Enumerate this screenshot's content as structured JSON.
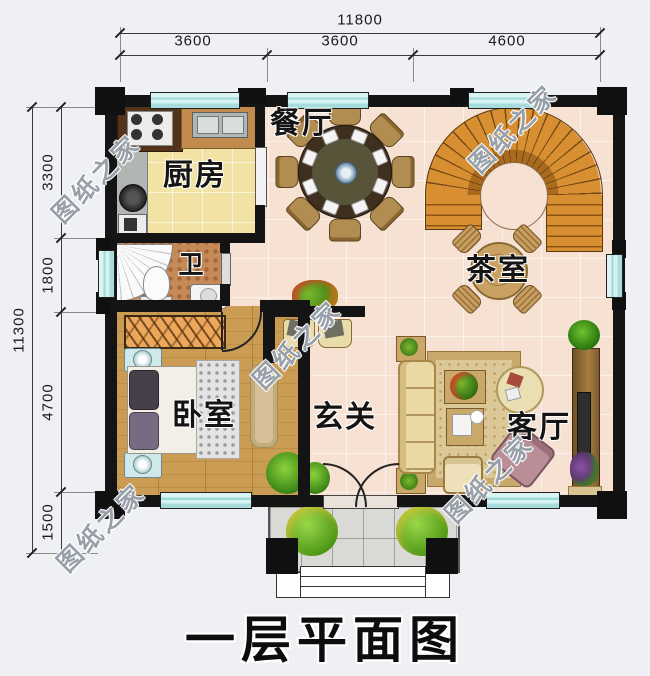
{
  "title": "一层平面图",
  "watermark": {
    "text": "图纸之家"
  },
  "dimensions": {
    "top": {
      "total": "11800",
      "segments": [
        "3600",
        "3600",
        "4600"
      ]
    },
    "left": {
      "total": "11300",
      "segments": [
        "3300",
        "1800",
        "4700",
        "1500"
      ]
    }
  },
  "rooms": {
    "kitchen": "厨房",
    "dining": "餐厅",
    "tea": "茶室",
    "bath": "卫",
    "bedroom": "卧室",
    "hall": "玄关",
    "living": "客厅"
  },
  "icons": {
    "stairs": "curved-staircase-icon",
    "dining_table": "round-dining-table-icon",
    "tea_table": "tea-table-icon",
    "bed": "double-bed-icon",
    "sofa": "sofa-icon",
    "tv_cabinet": "tv-cabinet-icon",
    "toilet": "toilet-icon",
    "shower": "corner-shower-icon",
    "stove": "gas-stove-icon",
    "sink": "kitchen-sink-icon"
  },
  "colors": {
    "wall": "#141414",
    "window": "#c6ecec",
    "floor_main": "#f6e1d2",
    "floor_kitchen": "#f2e3a5",
    "floor_bedroom": "#cb9d54",
    "floor_bath": "#c68a58",
    "stairs": "#d88f31",
    "background": "#eef0f4"
  }
}
